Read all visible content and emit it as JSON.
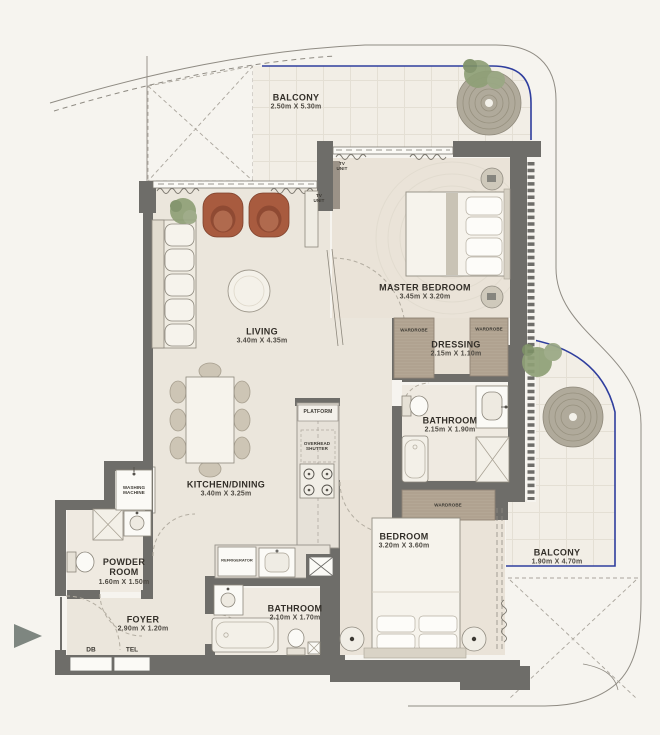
{
  "plan": {
    "rooms": [
      {
        "id": "balcony_top",
        "name": "BALCONY",
        "dims": "2.50m X 5.30m"
      },
      {
        "id": "master_bedroom",
        "name": "MASTER BEDROOM",
        "dims": "3.45m X 3.20m"
      },
      {
        "id": "living",
        "name": "LIVING",
        "dims": "3.40m X 4.35m"
      },
      {
        "id": "dressing",
        "name": "DRESSING",
        "dims": "2.15m X 1.10m"
      },
      {
        "id": "bathroom_master",
        "name": "BATHROOM",
        "dims": "2.15m X 1.90m"
      },
      {
        "id": "kitchen_dining",
        "name": "KITCHEN/DINING",
        "dims": "3.40m X 3.25m"
      },
      {
        "id": "powder_room",
        "name": "POWDER ROOM",
        "dims": "1.60m X 1.50m"
      },
      {
        "id": "foyer",
        "name": "FOYER",
        "dims": "2.90m X 1.20m"
      },
      {
        "id": "bathroom_2",
        "name": "BATHROOM",
        "dims": "2.10m X 1.70m"
      },
      {
        "id": "bedroom",
        "name": "BEDROOM",
        "dims": "3.20m X 3.60m"
      },
      {
        "id": "balcony_right",
        "name": "BALCONY",
        "dims": "1.90m X 4.70m"
      }
    ],
    "fixtures": {
      "washing_machine": "WASHING MACHINE",
      "tv_unit": "TV UNIT",
      "wardrobe": "WARDROBE",
      "platform": "PLATFORM",
      "overhead_shutter": "OVERHEAD SHUTTER",
      "refrigerator": "REFRIGERATOR",
      "db": "DB",
      "tel": "TEL"
    },
    "colors": {
      "background": "#f6f4ef",
      "floor": "#ebe6dc",
      "wall": "#6e6d69",
      "balcony_outline": "#2f3e9e",
      "armchair": "#a85b3f",
      "plant": "#8fa077",
      "wood": "#b4a795"
    }
  }
}
